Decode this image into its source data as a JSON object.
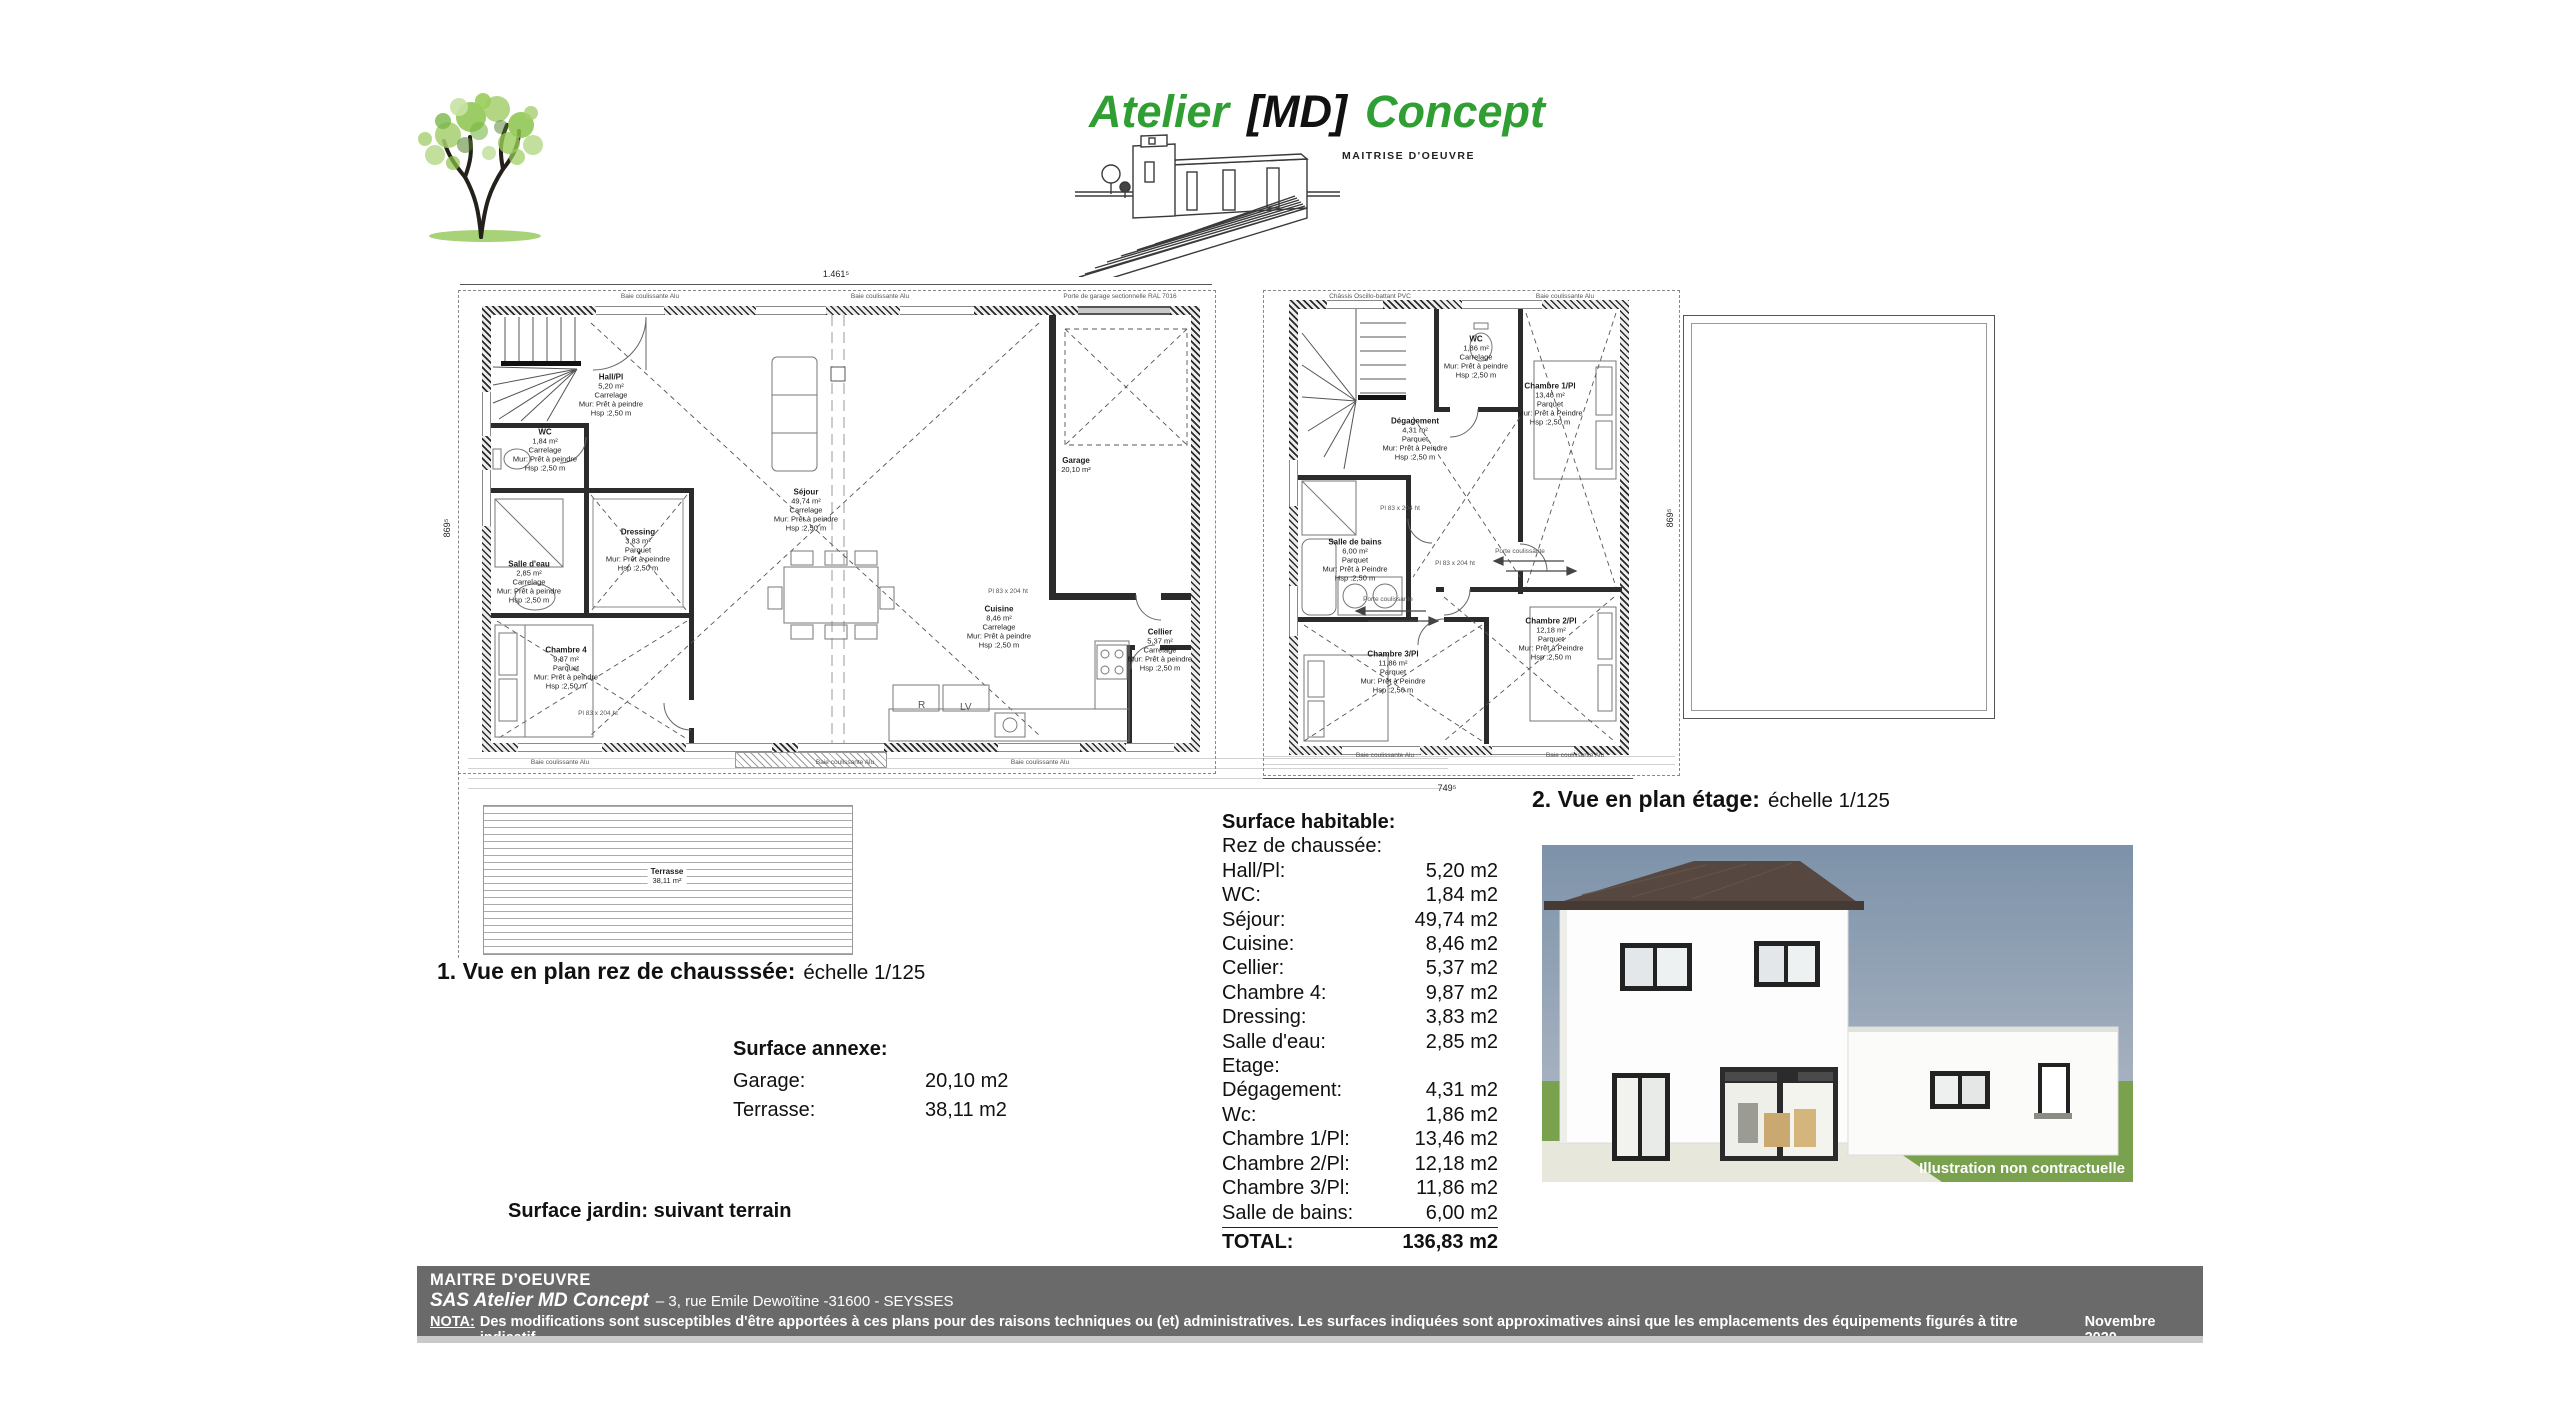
{
  "logo": {
    "brand_1": "Atelier",
    "brand_md": "[MD]",
    "brand_2": "Concept",
    "subtitle": "MAITRISE D'OEUVRE",
    "green": "#2f9e33"
  },
  "plan1": {
    "title": "1. Vue en plan rez de chausssée:",
    "scale": "échelle 1/125",
    "dims": {
      "top": "1.461⁵",
      "left": "869⁵"
    },
    "window_note": "Baie coulissante Alu",
    "garage_note": "Porte de garage sectionnelle RAL 7016",
    "door_note": "Pl 83 x 204 ht",
    "terrace": {
      "name": "Terrasse",
      "area": "38,11 m²"
    },
    "kitchen": {
      "fridge": "R",
      "dishwasher": "LV"
    },
    "rooms": [
      {
        "name": "Hall/Pl",
        "area": "5,20 m²",
        "floor": "Carrelage",
        "wall": "Mur: Prêt à peindre",
        "height": "Hsp :2,50 m"
      },
      {
        "name": "WC",
        "area": "1,84 m²",
        "floor": "Carrelage",
        "wall": "Mur: Prêt à peindre",
        "height": "Hsp :2,50 m"
      },
      {
        "name": "Salle d'eau",
        "area": "2,85 m²",
        "floor": "Carrelage",
        "wall": "Mur: Prêt à peindre",
        "height": "Hsp :2,50 m"
      },
      {
        "name": "Dressing",
        "area": "3,83 m²",
        "floor": "Parquet",
        "wall": "Mur: Prêt à peindre",
        "height": "Hsp :2,50 m"
      },
      {
        "name": "Chambre 4",
        "area": "9,87 m²",
        "floor": "Parquet",
        "wall": "Mur: Prêt à peindre",
        "height": "Hsp :2,50 m"
      },
      {
        "name": "Séjour",
        "area": "49,74 m²",
        "floor": "Carrelage",
        "wall": "Mur: Prêt à peindre",
        "height": "Hsp :2,50 m"
      },
      {
        "name": "Cuisine",
        "area": "8,46 m²",
        "floor": "Carrelage",
        "wall": "Mur: Prêt à peindre",
        "height": "Hsp :2,50 m"
      },
      {
        "name": "Cellier",
        "area": "5,37 m²",
        "floor": "Carrelage",
        "wall": "Mur: Prêt à peindre",
        "height": "Hsp :2,50 m"
      },
      {
        "name": "Garage",
        "area": "20,10 m²"
      }
    ]
  },
  "plan2": {
    "title": "2. Vue en plan étage:",
    "scale": "échelle 1/125",
    "dims": {
      "bottom": "749⁵",
      "right": "869⁵"
    },
    "window_note": "Baie coulissante Alu",
    "chassis_note": "Châssis Oscillo-battant PVC",
    "door_note": "Pl 83 x 204 ht",
    "porte_note": "Porte coulissante",
    "rooms": [
      {
        "name": "WC",
        "area": "1,86 m²",
        "floor": "Carrelage",
        "wall": "Mur: Prêt à peindre",
        "height": "Hsp :2,50 m"
      },
      {
        "name": "Chambre 1/Pl",
        "area": "13,46 m²",
        "floor": "Parquet",
        "wall": "Mur: Prêt à Peindre",
        "height": "Hsp :2,50 m"
      },
      {
        "name": "Dégagement",
        "area": "4,31 m²",
        "floor": "Parquet",
        "wall": "Mur: Prêt à Peindre",
        "height": "Hsp :2,50 m"
      },
      {
        "name": "Salle de bains",
        "area": "6,00 m²",
        "floor": "Parquet",
        "wall": "Mur: Prêt à Peindre",
        "height": "Hsp :2,50 m"
      },
      {
        "name": "Chambre 3/Pl",
        "area": "11,86 m²",
        "floor": "Parquet",
        "wall": "Mur: Prêt à Peindre",
        "height": "Hsp :2,50 m"
      },
      {
        "name": "Chambre 2/Pl",
        "area": "12,18 m²",
        "floor": "Parquet",
        "wall": "Mur: Prêt à Peindre",
        "height": "Hsp :2,50 m"
      }
    ]
  },
  "surfaces": {
    "habitable": {
      "title": "Surface habitable:",
      "rdc_label": "Rez de chaussée:",
      "etage_label": "Etage:",
      "rows_rdc": [
        {
          "label": "Hall/Pl:",
          "value": "5,20 m2"
        },
        {
          "label": "WC:",
          "value": "1,84 m2"
        },
        {
          "label": "Séjour:",
          "value": "49,74 m2"
        },
        {
          "label": "Cuisine:",
          "value": "8,46 m2"
        },
        {
          "label": "Cellier:",
          "value": "5,37 m2"
        },
        {
          "label": "Chambre 4:",
          "value": "9,87 m2"
        },
        {
          "label": "Dressing:",
          "value": "3,83 m2"
        },
        {
          "label": "Salle d'eau:",
          "value": "2,85 m2"
        }
      ],
      "rows_etage": [
        {
          "label": "Dégagement:",
          "value": "4,31 m2"
        },
        {
          "label": "Wc:",
          "value": "1,86 m2"
        },
        {
          "label": "Chambre 1/Pl:",
          "value": "13,46 m2"
        },
        {
          "label": "Chambre 2/Pl:",
          "value": "12,18 m2"
        },
        {
          "label": "Chambre 3/Pl:",
          "value": "11,86 m2"
        },
        {
          "label": "Salle de bains:",
          "value": "6,00 m2"
        }
      ],
      "total_label": "TOTAL:",
      "total_value": "136,83 m2"
    },
    "annexe": {
      "title": "Surface annexe:",
      "rows": [
        {
          "label": "Garage:",
          "value": "20,10 m2"
        },
        {
          "label": "Terrasse:",
          "value": "38,11 m2"
        }
      ]
    },
    "jardin": "Surface jardin: suivant terrain"
  },
  "illustration": {
    "caption": "Illustration non contractuelle"
  },
  "footer": {
    "line1": "MAITRE D'OEUVRE",
    "company": "SAS Atelier MD Concept",
    "address": "– 3, rue Emile Dewoïtine -31600  - SEYSSES",
    "nota_label": "NOTA:",
    "nota_text": "Des modifications sont susceptibles d'être apportées à ces plans pour des raisons techniques ou (et) administratives. Les surfaces indiquées sont approximatives ainsi que les emplacements des équipements figurés à titre indicatif.",
    "date": "Novembre 2020"
  }
}
